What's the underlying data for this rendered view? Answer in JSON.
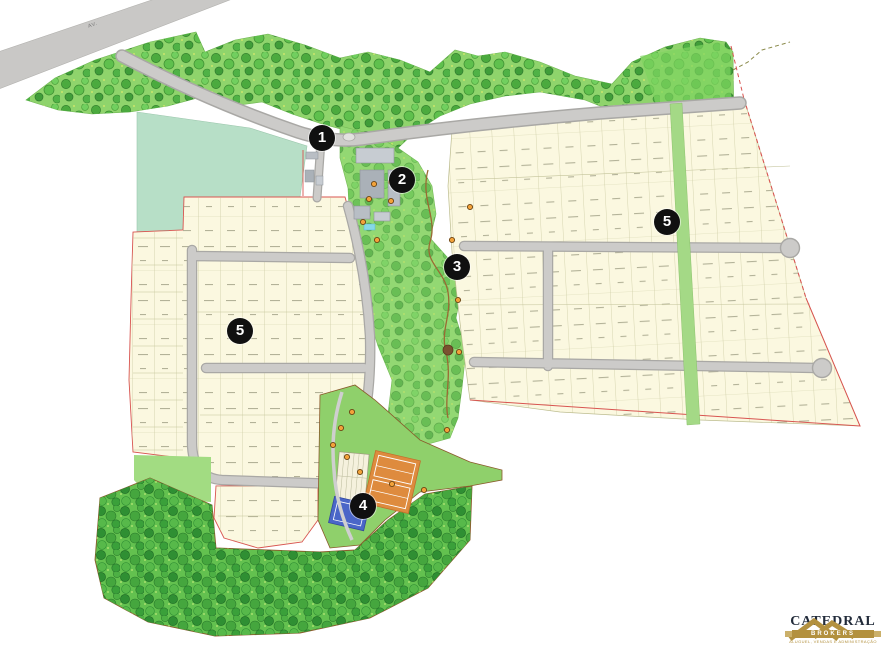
{
  "map": {
    "title": "Loteamento masterplan site map",
    "highway": {
      "label": "AV."
    },
    "markers": [
      {
        "label": "1",
        "x": 322,
        "y": 138
      },
      {
        "label": "2",
        "x": 402,
        "y": 180
      },
      {
        "label": "3",
        "x": 457,
        "y": 267
      },
      {
        "label": "4",
        "x": 363,
        "y": 506
      },
      {
        "label": "5",
        "x": 240,
        "y": 331
      },
      {
        "label": "5",
        "x": 667,
        "y": 222
      }
    ],
    "poi_icons": [
      [
        374,
        184
      ],
      [
        391,
        182
      ],
      [
        369,
        199
      ],
      [
        391,
        201
      ],
      [
        363,
        222
      ],
      [
        377,
        240
      ],
      [
        470,
        207
      ],
      [
        452,
        240
      ],
      [
        458,
        300
      ],
      [
        459,
        352
      ],
      [
        447,
        430
      ],
      [
        352,
        412
      ],
      [
        341,
        428
      ],
      [
        333,
        445
      ],
      [
        347,
        457
      ],
      [
        360,
        472
      ],
      [
        392,
        484
      ],
      [
        424,
        490
      ]
    ],
    "colors": {
      "road_fill": "#cccbc9",
      "road_casing": "#a9a8a5",
      "lot_fill": "#fbf8e0",
      "lot_line": "#bdbd90",
      "boundary_red": "#d85450",
      "boundary_brown": "#8a5a2b",
      "teal_field": "#b7dfc7",
      "forest_base": "#8fd46c",
      "forest_dense_base": "#63c14f",
      "park_green": "#93d873",
      "court_orange": "#de8b3e",
      "court_blue": "#4a66c8",
      "marker_bg": "#101010",
      "marker_text": "#ffffff",
      "poi_orange": "#f2a23a"
    }
  },
  "logo": {
    "name": "CATEDRAL",
    "sub": "BROKERS",
    "tagline": "ALUGUEL, VENDAS E ADMINISTRAÇÃO"
  }
}
